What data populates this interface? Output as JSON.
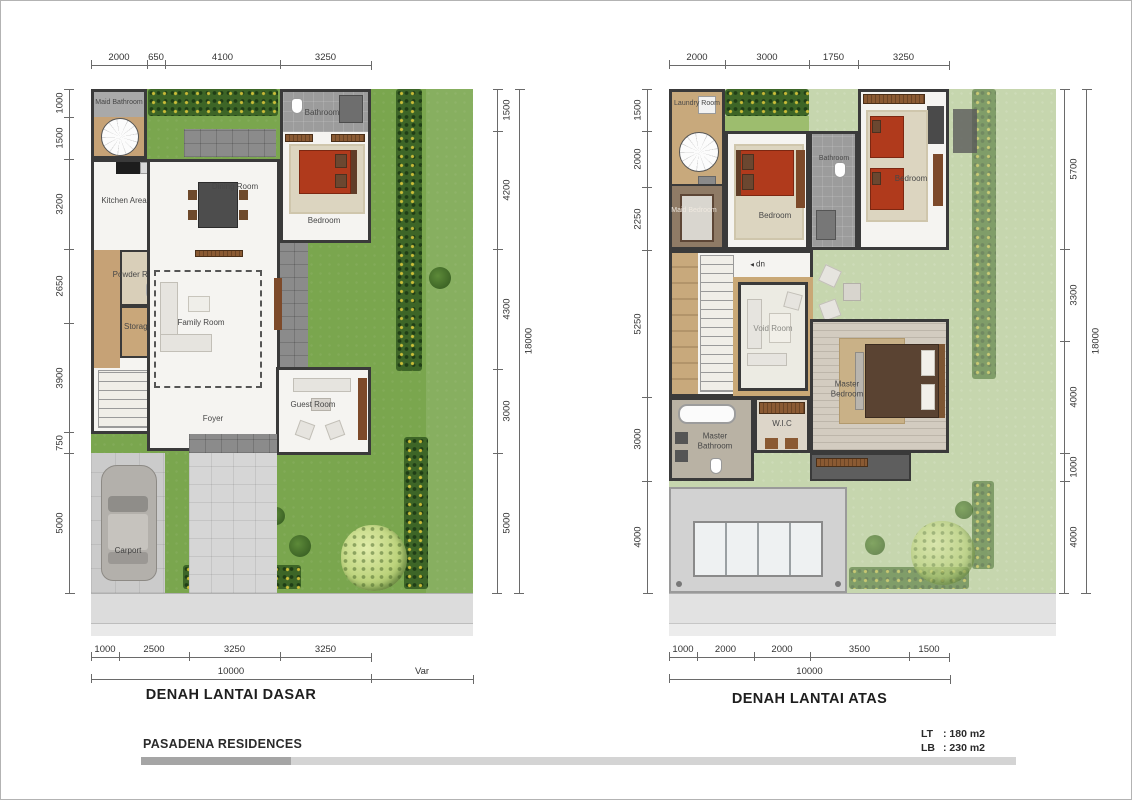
{
  "ground": {
    "title": "DENAH LANTAI DASAR",
    "dims": {
      "top": [
        "2000",
        "650",
        "4100",
        "3250"
      ],
      "left": [
        "1000",
        "1500",
        "3200",
        "2650",
        "3900",
        "750",
        "5000"
      ],
      "right": [
        "1500",
        "4200",
        "4300",
        "3000",
        "5000"
      ],
      "right_total": "18000",
      "bottom": [
        "1000",
        "2500",
        "3250",
        "3250"
      ],
      "bottom_total": "10000",
      "bottom_var": "Var"
    },
    "rooms": {
      "maid_bathroom": "Maid Bathroom",
      "kitchen": "Kitchen Area",
      "dining": "Dining Room",
      "bathroom": "Bathroom",
      "bedroom": "Bedroom",
      "powder": "Powder Room",
      "storage": "Storage",
      "family": "Family Room",
      "foyer": "Foyer",
      "guest": "Guest Room",
      "carport": "Carport"
    },
    "annotations": {
      "up": "up"
    }
  },
  "upper": {
    "title": "DENAH LANTAI ATAS",
    "dims": {
      "top": [
        "2000",
        "3000",
        "1750",
        "3250"
      ],
      "left": [
        "1500",
        "2000",
        "2250",
        "5250",
        "3000",
        "4000"
      ],
      "right": [
        "5700",
        "3300",
        "4000",
        "1000",
        "4000"
      ],
      "right_total": "18000",
      "bottom": [
        "1000",
        "2000",
        "2000",
        "3500",
        "1500"
      ],
      "bottom_total": "10000"
    },
    "rooms": {
      "laundry": "Laundry Room",
      "maid_bedroom": "Maid Bedroom",
      "bedroom_left": "Bedroom",
      "bathroom": "Bathroom",
      "bedroom_right": "Bedroom",
      "void_room": "Void Room",
      "master_bedroom": "Master Bedroom",
      "wic": "W.I.C",
      "master_bathroom": "Master Bathroom"
    },
    "annotations": {
      "dn": "dn"
    }
  },
  "footer": {
    "project": "PASADENA RESIDENCES",
    "lt": {
      "label": "LT",
      "value": ": 180 m2"
    },
    "lb": {
      "label": "LB",
      "value": ": 230 m2"
    }
  },
  "colors": {
    "wall": "#3a3a3a",
    "grass": "#7aa64e",
    "grass_washed": "#c6d6ae",
    "bed_accent": "#b03a1c"
  }
}
